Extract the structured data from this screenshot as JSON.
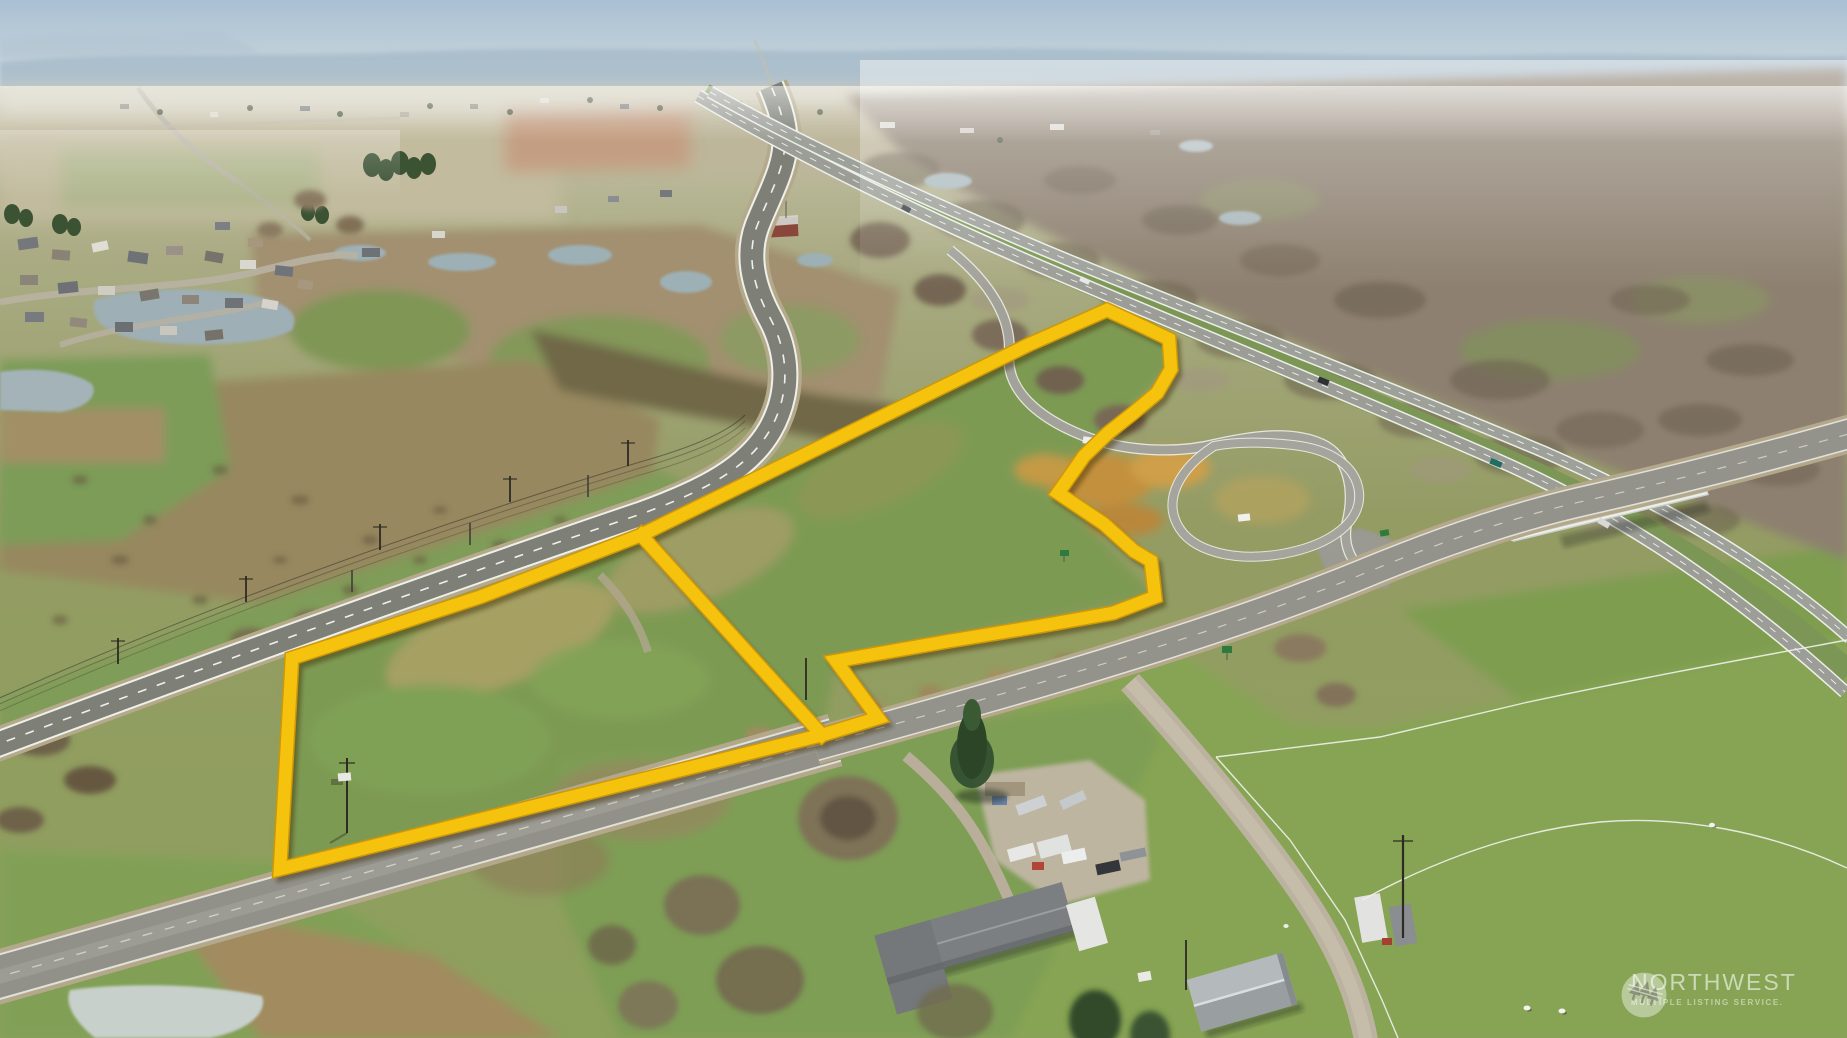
{
  "scene": {
    "type": "aerial-drone-photo",
    "season": "winter",
    "subject": "Vacant land property outlined in yellow along a rural road beside a highway interchange, with farmland, ponds, a housing subdivision, a homestead with RVs, and a white-fenced sheep pasture"
  },
  "property_outline": {
    "color": "#F5C30D",
    "edge_color": "#CE9707",
    "stroke_width": 12.5,
    "outer_points": [
      [
        1107,
        310
      ],
      [
        1146,
        328
      ],
      [
        1169,
        339
      ],
      [
        1171,
        369
      ],
      [
        1157,
        393
      ],
      [
        1132,
        414
      ],
      [
        1108,
        433
      ],
      [
        1084,
        456
      ],
      [
        1058,
        493
      ],
      [
        1104,
        524
      ],
      [
        1134,
        551
      ],
      [
        1151,
        561
      ],
      [
        1155,
        597
      ],
      [
        1113,
        613
      ],
      [
        1040,
        626
      ],
      [
        949,
        641
      ],
      [
        836,
        661
      ],
      [
        878,
        718
      ],
      [
        822,
        735
      ],
      [
        280,
        869
      ],
      [
        292,
        658
      ],
      [
        480,
        597
      ],
      [
        641,
        535
      ],
      [
        1030,
        344
      ]
    ],
    "divider_points": [
      [
        641,
        535
      ],
      [
        822,
        735
      ]
    ]
  },
  "watermark": {
    "brand": "NORTHWEST",
    "tagline": "MULTIPLE LISTING SERVICE.",
    "logo": "three-pines-circle-icon",
    "text_color": "rgba(255,255,255,0.58)"
  }
}
